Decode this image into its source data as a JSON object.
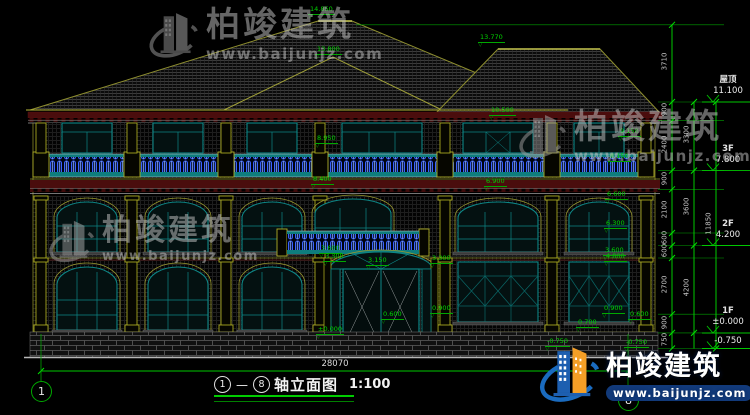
{
  "watermark": {
    "brand": "柏竣建筑",
    "url": "www.baijunjz.com"
  },
  "title": {
    "axis_from": "1",
    "axis_to": "8",
    "dash": "—",
    "name": "轴立面图",
    "scale": "1:100"
  },
  "axis_bubbles": {
    "left": "1",
    "right": "8"
  },
  "levels": [
    {
      "name": "屋顶",
      "value": "11.100"
    },
    {
      "name": "3F",
      "value": "7.800"
    },
    {
      "name": "2F",
      "value": "4.200"
    },
    {
      "name": "1F",
      "value": "±0.000"
    },
    {
      "name": "",
      "value": "-0.750"
    }
  ],
  "dims": {
    "total_width": "28070",
    "total_height": "11850",
    "right_outer": [
      "3710",
      "900",
      "2400",
      "900",
      "2100",
      "600",
      "600",
      "2700",
      "900",
      "750"
    ],
    "right_inner": [
      "3300",
      "3600",
      "4200"
    ]
  },
  "spots": [
    "14.850",
    "13.800",
    "13.770",
    "10.500",
    "8.950",
    "9.150",
    "8.150",
    "8.400",
    "6.900",
    "6.600",
    "6.300",
    "4.800",
    "3.600",
    "3.300",
    "3.150",
    "3.300",
    "3.600",
    "0.600",
    "±0.000",
    "0.900",
    "0.900",
    "0.700",
    "0.600",
    "-0.750",
    "-0.750"
  ],
  "colors": {
    "dim_green": "#00c800",
    "spot_green": "#00d400",
    "window_teal": "#0d8686",
    "baluster_blue": "#3a62ff",
    "pilaster_yellow": "#a8a820",
    "cornice_red": "#4a0d0d",
    "brand_blue": "#1d5fb0",
    "brand_orange": "#f59f26"
  }
}
